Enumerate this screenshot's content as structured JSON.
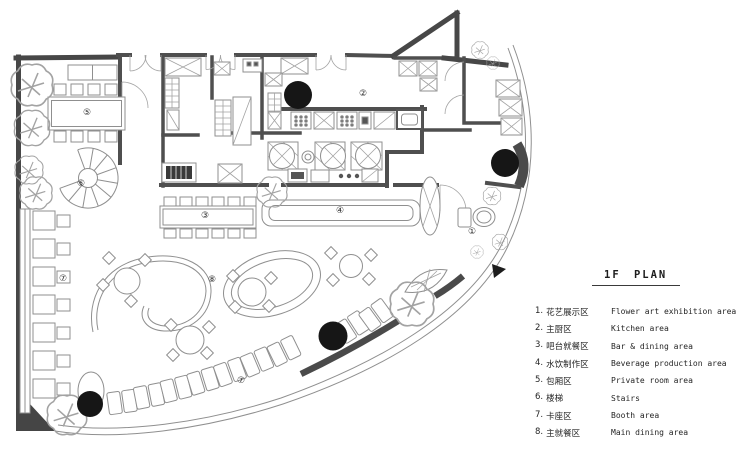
{
  "plan": {
    "title_note": "first floor restaurant plan",
    "labels": [
      {
        "symbol": "①",
        "area": "flower-art-exhibition-area"
      },
      {
        "symbol": "②",
        "area": "kitchen-area"
      },
      {
        "symbol": "③",
        "area": "bar-dining-area"
      },
      {
        "symbol": "④",
        "area": "beverage-production-area"
      },
      {
        "symbol": "⑤",
        "area": "private-room-area"
      },
      {
        "symbol": "⑥",
        "area": "stairs"
      },
      {
        "symbol": "⑦",
        "area": "booth-area"
      },
      {
        "symbol": "⑦",
        "area": "booth-area"
      },
      {
        "symbol": "⑧",
        "area": "main-dining-area"
      }
    ],
    "colors": {
      "wall": "#474747",
      "thin_line": "#8f8f8f",
      "column": "#161616",
      "background": "#ffffff"
    }
  },
  "legend": {
    "title": "1F PLAN",
    "items": [
      {
        "num": "1.",
        "zh": "花艺展示区",
        "en": "Flower art exhibition area"
      },
      {
        "num": "2.",
        "zh": "主厨区",
        "en": "Kitchen area"
      },
      {
        "num": "3.",
        "zh": "吧台就餐区",
        "en": "Bar & dining area"
      },
      {
        "num": "4.",
        "zh": "水饮制作区",
        "en": "Beverage production area"
      },
      {
        "num": "5.",
        "zh": "包厢区",
        "en": "Private room area"
      },
      {
        "num": "6.",
        "zh": "楼梯",
        "en": "Stairs"
      },
      {
        "num": "7.",
        "zh": "卡座区",
        "en": "Booth area"
      },
      {
        "num": "8.",
        "zh": "主就餐区",
        "en": "Main dining area"
      }
    ]
  }
}
